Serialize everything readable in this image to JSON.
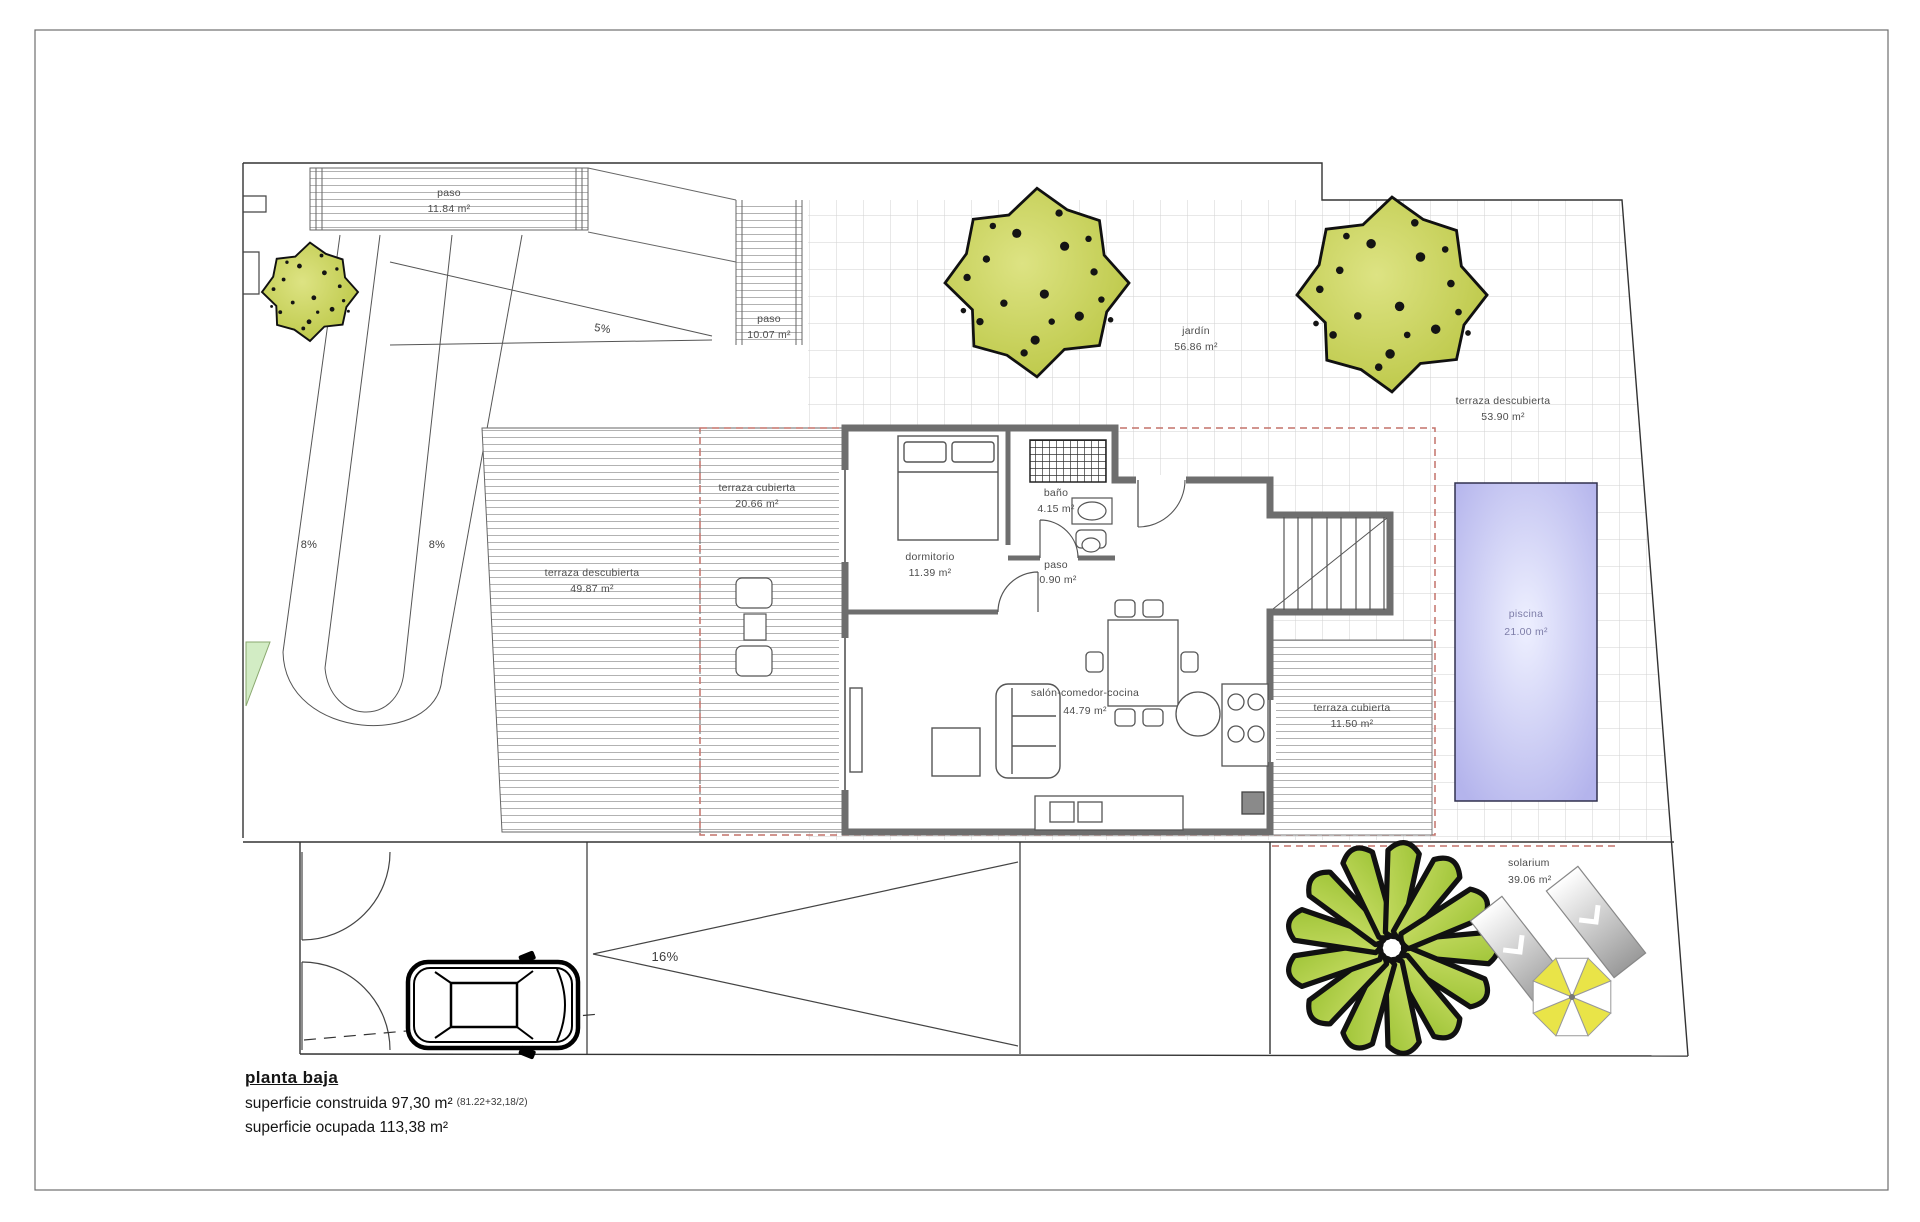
{
  "plan": {
    "areas": {
      "paso_top": {
        "name": "paso",
        "area": "11.84 m²"
      },
      "paso_mid": {
        "name": "paso",
        "area": "10.07 m²"
      },
      "jardin": {
        "name": "jardín",
        "area": "56.86 m²"
      },
      "terraza_descubierta_este": {
        "name": "terraza descubierta",
        "area": "53.90 m²"
      },
      "terraza_cubierta_oeste": {
        "name": "terraza cubierta",
        "area": "20.66 m²"
      },
      "terraza_descubierta_oeste": {
        "name": "terraza descubierta",
        "area": "49.87 m²"
      },
      "dormitorio": {
        "name": "dormitorio",
        "area": "11.39 m²"
      },
      "bano": {
        "name": "baño",
        "area": "4.15 m²"
      },
      "paso_interior": {
        "name": "paso",
        "area": "0.90 m²"
      },
      "salon_comedor_cocina": {
        "name": "salón-comedor-cocina",
        "area": "44.79 m²"
      },
      "terraza_cubierta_este": {
        "name": "terraza cubierta",
        "area": "11.50 m²"
      },
      "piscina": {
        "name": "piscina",
        "area": "21.00 m²"
      },
      "solarium": {
        "name": "solarium",
        "area": "39.06 m²"
      }
    },
    "slopes": {
      "acceso": "5%",
      "rampa_izq": "8%",
      "rampa_der": "8%",
      "garaje": "16%"
    },
    "footer": {
      "title": "planta baja",
      "superficie_construida": "superficie construida 97,30 m²",
      "superficie_construida_detalle": "(81.22+32,18/2)",
      "superficie_ocupada": "superficie ocupada 113,38 m²"
    },
    "colors": {
      "wall": "#6e6e6e",
      "tree_fill": "#b9c542",
      "palm_fill": "#9fc437",
      "pool_center": "#eef0ff",
      "pool_edge": "#b4b4ec",
      "umbrella_yellow": "#e9e448",
      "projection_dash": "#c4726a",
      "grass_patch": "#d2ecc4"
    }
  }
}
